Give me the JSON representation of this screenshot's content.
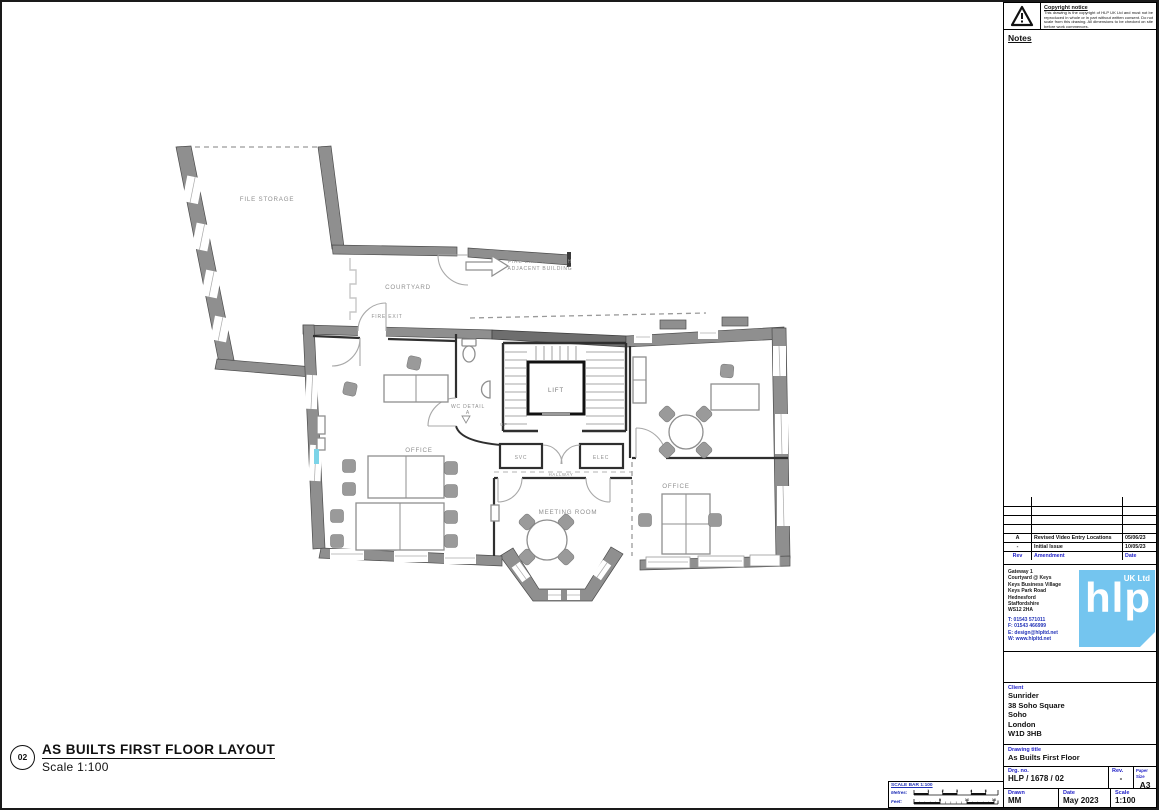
{
  "copyright": {
    "title": "Copyright notice",
    "body": "This drawing is the copyright of HLP UK Ltd and must not be reproduced in whole or in part without written consent. Do not scale from this drawing. All dimensions to be checked on site before work commences."
  },
  "notes": {
    "label": "Notes"
  },
  "revision_table": {
    "headers": {
      "rev": "Rev",
      "amendment": "Amendment",
      "date": "Date"
    },
    "rows": [
      {
        "rev": "A",
        "amendment": "Revised Video Entry Locations",
        "date": "05/06/23"
      },
      {
        "rev": "-",
        "amendment": "Initial Issue",
        "date": "10/05/23"
      }
    ]
  },
  "company": {
    "address_lines": [
      "Gateway 1",
      "Courtyard @ Keys",
      "Keys Business Village",
      "Keys Park Road",
      "Hednesford",
      "Staffordshire",
      "WS12 2HA"
    ],
    "contact_lines": [
      "T: 01543 571011",
      "F: 01543 466999",
      "E: design@hlpltd.net",
      "W: www.hlpltd.net"
    ],
    "logo": {
      "text": "hlp",
      "suffix": "UK Ltd",
      "color": "#74c5ef"
    }
  },
  "client": {
    "label": "Client",
    "lines": [
      "Sunrider",
      "38 Soho Square",
      "Soho",
      "London",
      "W1D 3HB"
    ]
  },
  "drawing_title": {
    "label": "Drawing title",
    "value": "As Builts First Floor"
  },
  "drawing_info": {
    "drg_label": "Drg. no.",
    "drg_value": "HLP / 1678 / 02",
    "rev_label": "Rev.",
    "rev_value": "-",
    "paper_label": "Paper Size",
    "paper_value": "A3",
    "drawn_label": "Drawn",
    "drawn_value": "MM",
    "date_label": "Date",
    "date_value": "May 2023",
    "scale_label": "Scale",
    "scale_value": "1:100"
  },
  "plan_title": {
    "ref": "02",
    "title": "AS BUILTS FIRST FLOOR LAYOUT",
    "scale": "Scale 1:100"
  },
  "plan_labels": {
    "file_storage": "FILE STORAGE",
    "courtyard": "COURTYARD",
    "fire_exit": "FIRE EXIT",
    "fire_exit_through_1": "FIRE EXIT THROUGH",
    "fire_exit_through_2": "ADJACENT BUILDING",
    "lift": "LIFT",
    "wc_detail_1": "WC DETAIL",
    "wc_detail_2": "A",
    "up": "UP",
    "svc": "SVC",
    "elec": "ELEC",
    "hallway": "HALLWAY",
    "office_left": "OFFICE",
    "meeting_room": "MEETING ROOM",
    "office_right": "OFFICE"
  },
  "scale_bar": {
    "title": "SCALE BAR 1:100",
    "metres_label": "Metres:",
    "feet_label": "Feet:",
    "metres_ticks": [
      "1",
      "2",
      "3",
      "4",
      "5"
    ],
    "feet_ticks": [
      "5",
      "10",
      "15"
    ]
  }
}
